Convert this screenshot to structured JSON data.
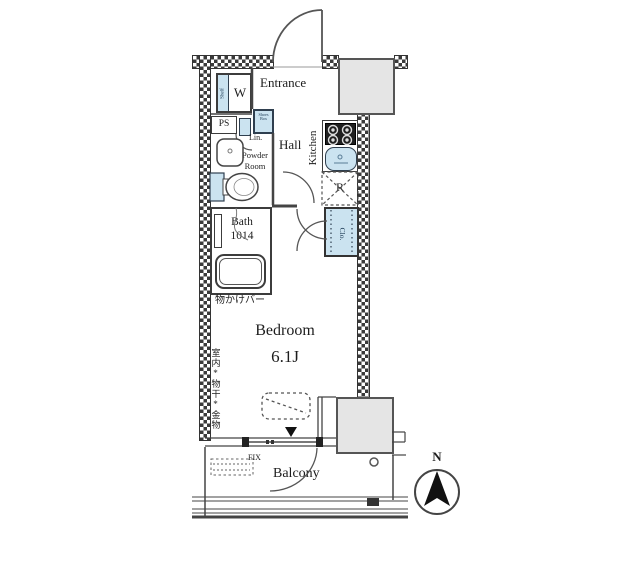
{
  "title": "apartment-floor-plan",
  "labels": {
    "entrance": "Entrance",
    "hall": "Hall",
    "kitchen": "Kitchen",
    "powder_1": "Powder",
    "powder_2": "Room",
    "bath": "Bath",
    "bath_size": "1014",
    "bedroom": "Bedroom",
    "bedroom_size": "6.1J",
    "balcony": "Balcony",
    "fix_window": "FIX",
    "washing_machine": "W",
    "shelf": "Shelf",
    "pipe_space": "PS",
    "shoes_1": "Shoes",
    "shoes_2": "Box",
    "linen": "Lin.",
    "refrigerator": "R",
    "closet": "Clo.",
    "hanger_bar": "物かけバー",
    "indoor_drying_hardware": "室内*物干*金物",
    "north": "N"
  },
  "colors": {
    "fixture_blue": "#cbe3f0",
    "wall_dark": "#3a3a3a",
    "block_gray": "#e5e5e5",
    "line": "#444444",
    "stove_dark": "#1f1f1f"
  }
}
